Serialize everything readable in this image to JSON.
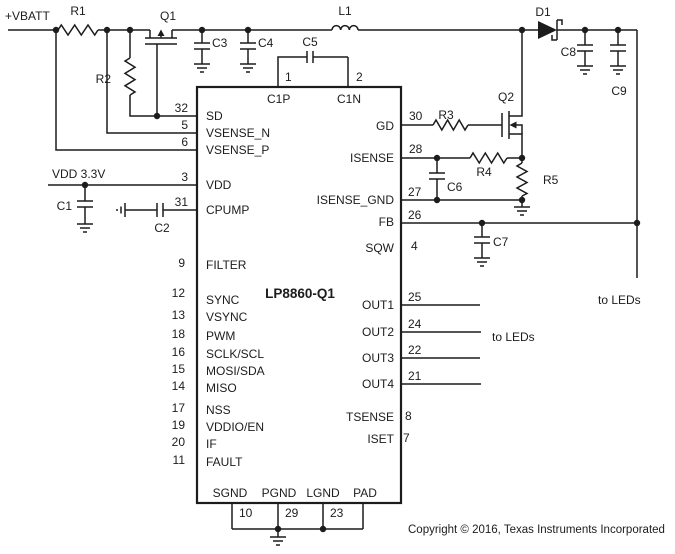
{
  "power_labels": {
    "vbatt": "+VBATT",
    "vdd_rail": "VDD 3.3V"
  },
  "components": {
    "r1": "R1",
    "r2": "R2",
    "r3": "R3",
    "r4": "R4",
    "r5": "R5",
    "c1": "C1",
    "c2": "C2",
    "c3": "C3",
    "c4": "C4",
    "c5": "C5",
    "c6": "C6",
    "c7": "C7",
    "c8": "C8",
    "c9": "C9",
    "l1": "L1",
    "q1": "Q1",
    "q2": "Q2",
    "d1": "D1"
  },
  "ic": {
    "name": "LP8860-Q1",
    "top_pins": [
      {
        "num": "1",
        "label": "C1P"
      },
      {
        "num": "2",
        "label": "C1N"
      }
    ],
    "left_pins": [
      {
        "num": "32",
        "label": "SD"
      },
      {
        "num": "5",
        "label": "VSENSE_N"
      },
      {
        "num": "6",
        "label": "VSENSE_P"
      },
      {
        "num": "3",
        "label": "VDD"
      },
      {
        "num": "31",
        "label": "CPUMP"
      },
      {
        "num": "9",
        "label": "FILTER"
      },
      {
        "num": "12",
        "label": "SYNC"
      },
      {
        "num": "13",
        "label": "VSYNC"
      },
      {
        "num": "18",
        "label": "PWM"
      },
      {
        "num": "16",
        "label": "SCLK/SCL"
      },
      {
        "num": "15",
        "label": "MOSI/SDA"
      },
      {
        "num": "14",
        "label": "MISO"
      },
      {
        "num": "17",
        "label": "NSS"
      },
      {
        "num": "19",
        "label": "VDDIO/EN"
      },
      {
        "num": "20",
        "label": "IF"
      },
      {
        "num": "11",
        "label": "FAULT"
      }
    ],
    "right_pins": [
      {
        "num": "30",
        "label": "GD"
      },
      {
        "num": "28",
        "label": "ISENSE"
      },
      {
        "num": "27",
        "label": "ISENSE_GND"
      },
      {
        "num": "26",
        "label": "FB"
      },
      {
        "num": "4",
        "label": "SQW"
      },
      {
        "num": "25",
        "label": "OUT1"
      },
      {
        "num": "24",
        "label": "OUT2"
      },
      {
        "num": "22",
        "label": "OUT3"
      },
      {
        "num": "21",
        "label": "OUT4"
      },
      {
        "num": "8",
        "label": "TSENSE"
      },
      {
        "num": "7",
        "label": "ISET"
      }
    ],
    "bottom_pins": [
      {
        "num": "10",
        "label": "SGND"
      },
      {
        "num": "29",
        "label": "PGND"
      },
      {
        "num": "23",
        "label": "LGND"
      },
      {
        "num": "",
        "label": "PAD"
      }
    ]
  },
  "annotations": {
    "to_leds_outputs": "to LEDs",
    "to_leds_feedback": "to LEDs",
    "copyright": "Copyright © 2016, Texas Instruments Incorporated"
  },
  "colors": {
    "wire": "#1c1c1c",
    "background": "#ffffff"
  }
}
